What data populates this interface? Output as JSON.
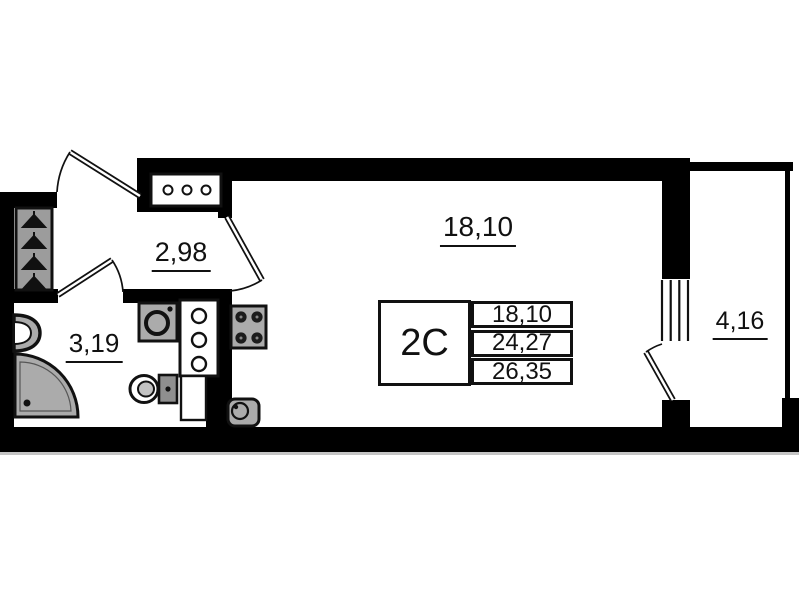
{
  "plan": {
    "title": "studio-apartment-floor-plan",
    "rooms": {
      "hallway": {
        "name": "hallway",
        "area": "2,98"
      },
      "bathroom": {
        "name": "bathroom",
        "area": "3,19"
      },
      "living": {
        "name": "living-room",
        "area": "18,10"
      },
      "balcony": {
        "name": "balcony",
        "area": "4,16"
      }
    },
    "info_table": {
      "unit_type": "2С",
      "rows": [
        "18,10",
        "24,27",
        "26,35"
      ]
    },
    "colors": {
      "wall": "#000000",
      "line": "#111111",
      "fixture_fill": "#ababab",
      "wardrobe_fill": "#9c9c9c",
      "background": "#ffffff"
    },
    "fixtures": [
      "entrance-door",
      "wardrobe-hangers",
      "electrical-panel",
      "washing-machine",
      "ventilation-cabinet",
      "toilet",
      "shower",
      "wash-basin",
      "stove",
      "kitchen-sink",
      "balcony-window",
      "balcony-door"
    ]
  }
}
